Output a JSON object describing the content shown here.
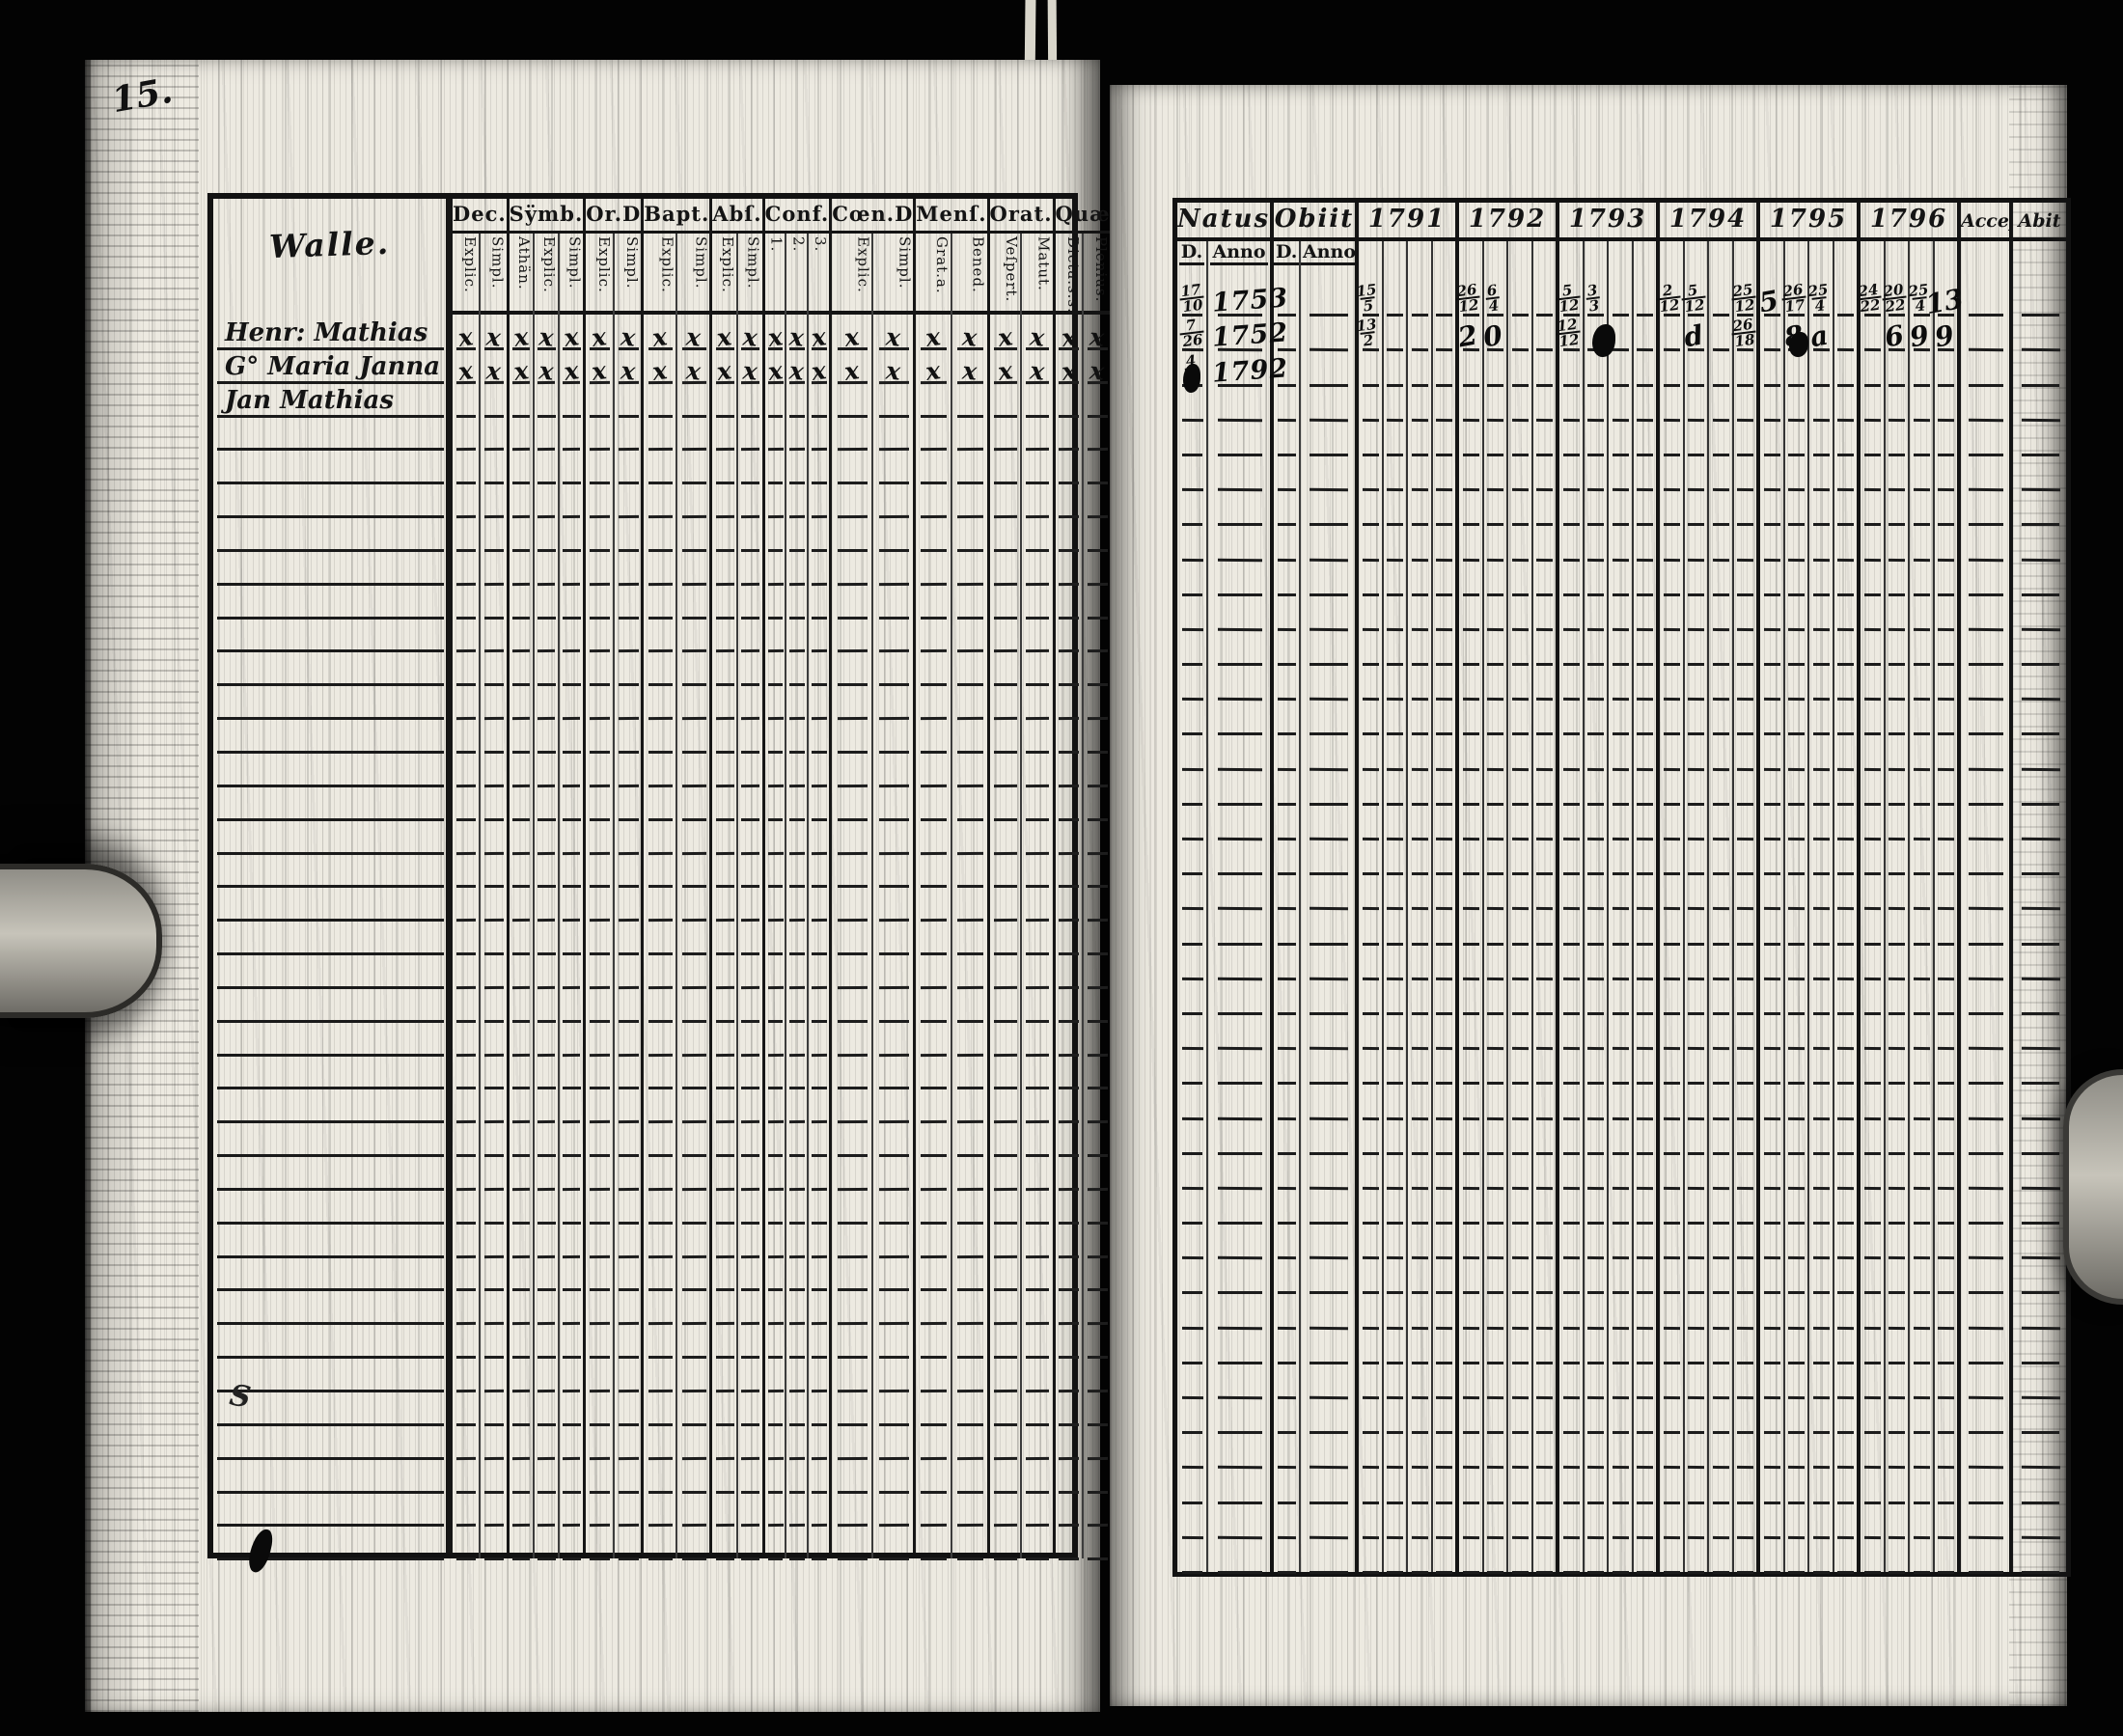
{
  "page_number": "15.",
  "left_page": {
    "title": "Walle.",
    "x_mark_char": "x",
    "rows_total": 37,
    "groups": [
      {
        "label": "Dec.",
        "subs": [
          "Explic.",
          "Simpl."
        ]
      },
      {
        "label": "Sÿmb.",
        "subs": [
          "Athän.",
          "Explic.",
          "Simpl."
        ]
      },
      {
        "label": "Or.D",
        "subs": [
          "Explic.",
          "Simpl."
        ]
      },
      {
        "label": "Bapt.",
        "subs": [
          "Explic.",
          "Simpl."
        ]
      },
      {
        "label": "Abſ.",
        "subs": [
          "Explic.",
          "Simpl."
        ]
      },
      {
        "label": "Conf.",
        "subs": [
          "1.",
          "2.",
          "3."
        ]
      },
      {
        "label": "Cœn.D",
        "subs": [
          "Explic.",
          "Simpl."
        ]
      },
      {
        "label": "Menſ.",
        "subs": [
          "Grat.a.",
          "Bened."
        ]
      },
      {
        "label": "Orat.",
        "subs": [
          "Veſpert.",
          "Matut."
        ]
      },
      {
        "label": "Quæſt.",
        "subs": [
          "Dicta.s.s.",
          "Plenius.",
          "Alia.m."
        ]
      },
      {
        "label": "Tabæ.",
        "subs": [
          "Plenius.",
          "Alia.m."
        ]
      },
      {
        "label": "L.n.",
        "subs": [
          "Exact.",
          "Alia.m."
        ]
      }
    ],
    "entries": [
      {
        "name": "Henr: Mathias",
        "marks": "all-x"
      },
      {
        "name": "G° Maria Janna",
        "marks": "all-x"
      },
      {
        "name": "Jan Mathias",
        "marks": "none"
      }
    ],
    "margin_squiggle": "S"
  },
  "right_page": {
    "header": {
      "natus": "Natus",
      "obiit": "Obiit",
      "years": [
        "1791",
        "1792",
        "1793",
        "1794",
        "1795",
        "1796"
      ],
      "acces": "Acceſ",
      "abit": "Abit",
      "d_label": "D.",
      "anno_label": "Anno"
    },
    "rows_total": 37,
    "entries": [
      {
        "natus_d_num": "17",
        "natus_d_den": "10",
        "natus_anno": "1753",
        "cells": [
          {
            "y": "1791",
            "s": 0,
            "n": "15",
            "d": "5"
          },
          {
            "y": "1792",
            "s": 0,
            "n": "26",
            "d": "12"
          },
          {
            "y": "1792",
            "s": 1,
            "n": "6",
            "d": "4"
          },
          {
            "y": "1793",
            "s": 0,
            "n": "5",
            "d": "12"
          },
          {
            "y": "1793",
            "s": 1,
            "n": "3",
            "d": "3"
          },
          {
            "y": "1794",
            "s": 0,
            "n": "2",
            "d": "12"
          },
          {
            "y": "1794",
            "s": 1,
            "n": "5",
            "d": "12"
          },
          {
            "y": "1794",
            "s": 3,
            "n": "25",
            "d": "12"
          },
          {
            "y": "1795",
            "s": 0,
            "t": "5"
          },
          {
            "y": "1795",
            "s": 1,
            "n": "26",
            "d": "17"
          },
          {
            "y": "1795",
            "s": 2,
            "n": "25",
            "d": "4"
          },
          {
            "y": "1796",
            "s": 0,
            "n": "24",
            "d": "22"
          },
          {
            "y": "1796",
            "s": 1,
            "n": "20",
            "d": "22"
          },
          {
            "y": "1796",
            "s": 2,
            "n": "25",
            "d": "4"
          },
          {
            "y": "1796",
            "s": 3,
            "t": "13"
          }
        ]
      },
      {
        "natus_d_num": "7",
        "natus_d_den": "26",
        "natus_anno": "1752",
        "cells": [
          {
            "y": "1791",
            "s": 0,
            "n": "13",
            "d": "2"
          },
          {
            "y": "1792",
            "s": 0,
            "t": "2"
          },
          {
            "y": "1792",
            "s": 1,
            "t": "0"
          },
          {
            "y": "1793",
            "s": 0,
            "n": "12",
            "d": "12"
          },
          {
            "y": "1794",
            "s": 1,
            "t": "d"
          },
          {
            "y": "1794",
            "s": 3,
            "n": "26",
            "d": "18"
          },
          {
            "y": "1795",
            "s": 1,
            "t": "8"
          },
          {
            "y": "1795",
            "s": 2,
            "t": "a"
          },
          {
            "y": "1796",
            "s": 1,
            "t": "6"
          },
          {
            "y": "1796",
            "s": 2,
            "t": "9"
          },
          {
            "y": "1796",
            "s": 3,
            "t": "9"
          }
        ]
      },
      {
        "natus_d_num": "4",
        "natus_d_den": "2",
        "natus_anno": "1792",
        "cells": []
      }
    ]
  }
}
